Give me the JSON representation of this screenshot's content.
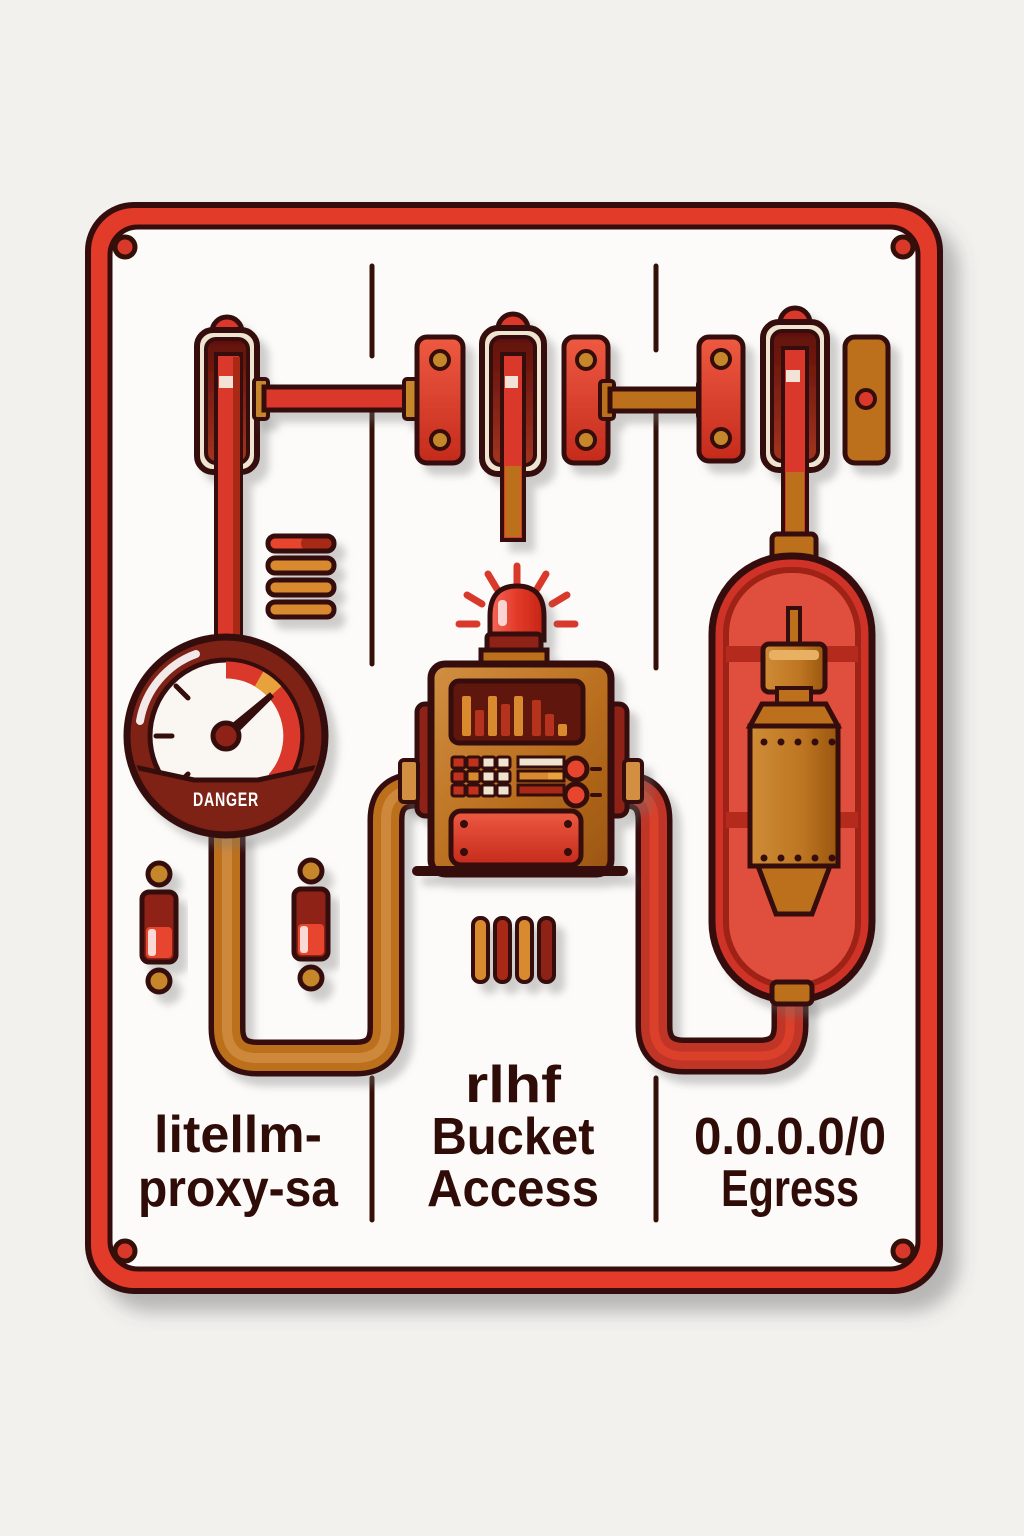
{
  "poster": {
    "gauge_label": "DANGER",
    "columns": [
      {
        "id": "service-account",
        "lines": [
          "litellm-",
          "proxy-sa"
        ]
      },
      {
        "id": "bucket-access",
        "lines": [
          "rlhf",
          "Bucket",
          "Access"
        ]
      },
      {
        "id": "egress",
        "lines": [
          "0.0.0.0/0",
          "Egress"
        ]
      }
    ]
  },
  "colors": {
    "background": "#f3f1ee",
    "panel": "#fcfbf9",
    "panel_border": "#e23a2a",
    "outline": "#351008",
    "red": "#d9392b",
    "red_bright": "#e8452f",
    "red_dark": "#a82a18",
    "dark_red": "#8e2316",
    "maroon": "#7e2015",
    "capsule": "#cf3325",
    "capsule_inner": "#e0503e",
    "capsule_cage": "#9e2316",
    "pipe_red": "#c13526",
    "bronze": "#bc6f1f",
    "bronze_light": "#d28f42",
    "brass": "#c5872a",
    "cream": "#efe4d0",
    "gold": "#e8a23b",
    "orange": "#d98a2e",
    "screen": "#5f120c",
    "text": "#2f0c07",
    "white": "#faf7f3"
  },
  "control_box": {
    "screen_bars": [
      {
        "x": 462,
        "h": 40,
        "color": "#d98a2e"
      },
      {
        "x": 475,
        "h": 26,
        "color": "#b5321f"
      },
      {
        "x": 488,
        "h": 40,
        "color": "#d98a2e"
      },
      {
        "x": 501,
        "h": 32,
        "color": "#b5321f"
      },
      {
        "x": 514,
        "h": 40,
        "color": "#d98a2e"
      },
      {
        "x": 532,
        "h": 36,
        "color": "#b5321f"
      },
      {
        "x": 545,
        "h": 22,
        "color": "#b5321f"
      },
      {
        "x": 558,
        "h": 12,
        "color": "#d98a2e"
      }
    ],
    "keypad": [
      [
        "#c1331f",
        "#c1331f",
        "#f0e4cf",
        "#f0e4cf"
      ],
      [
        "#c1331f",
        "#d98a2e",
        "#f0e4cf",
        "#f0e4cf"
      ],
      [
        "#c1331f",
        "#c1331f",
        "#f0e4cf",
        "#f0e4cf"
      ]
    ]
  }
}
